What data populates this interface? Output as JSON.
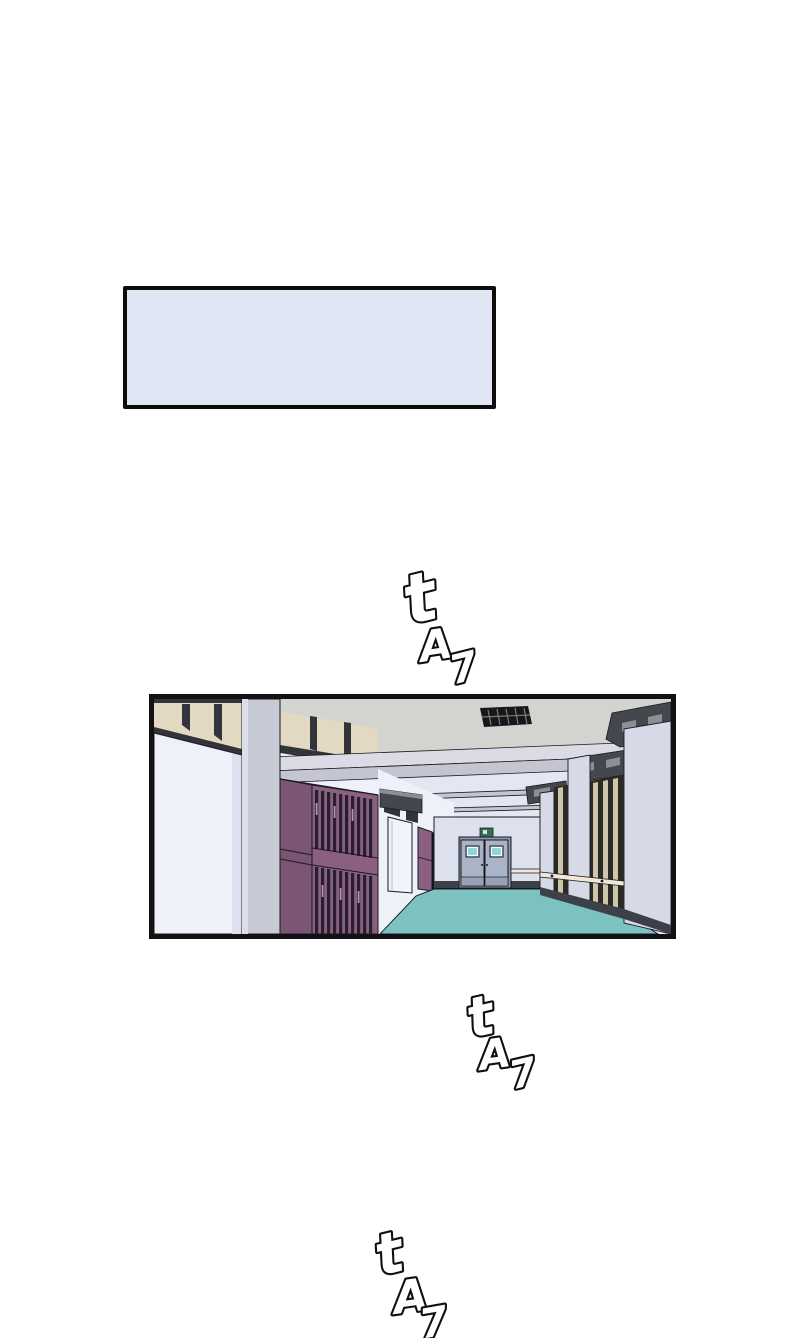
{
  "page": {
    "background": "#ffffff"
  },
  "caption": {
    "text": "",
    "fill": "#e1e6f5",
    "border": "#0d0d0d"
  },
  "panel": {
    "description": "school hallway interior with purple lockers, teal floor and double doors at the end",
    "colors": {
      "ceiling_front": "#d3d3cf",
      "ceiling_inner": "#e4e6f1",
      "beam_light": "#dadbe4",
      "beam_under": "#c4c5d1",
      "wall_white": "#eef0fa",
      "wall_shade": "#dde0ee",
      "window_tan": "#e3d8c2",
      "window_tan2": "#cfc5ab",
      "frame_dark": "#33343a",
      "frame_dark2": "#2b2a26",
      "pillar_gray": "#c7c9d5",
      "pillar_light": "#d6d9e6",
      "locker_front": "#8a5f82",
      "locker_side": "#7b5674",
      "locker_slot": "#281f2e",
      "locker_vent": "#b198ac",
      "end_wall": "#dde1ee",
      "door": "#aab4c8",
      "door_window": "#8fd4d8",
      "floor": "#7cc2c0",
      "baseboard": "#3c4149",
      "sign_dark": "#44484e",
      "sign_light": "#8b8f96",
      "handrail": "#efe8d9",
      "exit_sign": "#36705b",
      "dark_opening": "#141419",
      "outline": "#1a1a1e",
      "caption_fill": "#e1e6f5"
    }
  },
  "sfx": [
    {
      "letters": [
        "t",
        "A",
        "7"
      ]
    },
    {
      "letters": [
        "t",
        "A",
        "7"
      ]
    },
    {
      "letters": [
        "t",
        "A",
        "7"
      ]
    }
  ]
}
